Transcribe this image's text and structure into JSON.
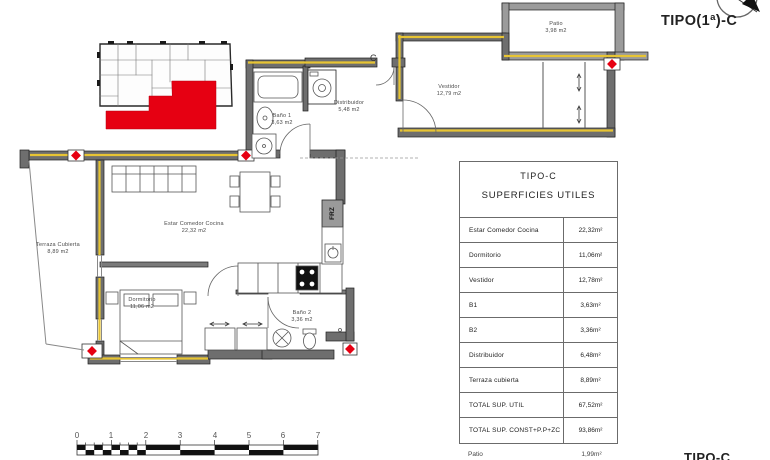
{
  "header": {
    "title": "TIPO(1ª)-C"
  },
  "footer": {
    "label": "TIPO-C"
  },
  "plan": {
    "section_marker": "C",
    "fridge_label": "FRZ",
    "rooms": [
      {
        "name": "Patio",
        "area": "3,98 m2"
      },
      {
        "name": "Vestidor",
        "area": "12,79 m2"
      },
      {
        "name": "Distribuidor",
        "area": "5,48 m2"
      },
      {
        "name": "Baño 1",
        "area": "3,63 m2"
      },
      {
        "name": "Estar Comedor Cocina",
        "area": "22,32 m2"
      },
      {
        "name": "Terraza Cubierta",
        "area": "8,89 m2"
      },
      {
        "name": "Dormitorio",
        "area": "11,06 m2"
      },
      {
        "name": "Baño 2",
        "area": "3,36 m2"
      }
    ]
  },
  "table": {
    "title_line1": "TIPO-C",
    "title_line2": "SUPERFICIES UTILES",
    "rows": [
      {
        "label": "Estar Comedor Cocina",
        "value": "22,32m²"
      },
      {
        "label": "Dormitorio",
        "value": "11,06m²"
      },
      {
        "label": "Vestidor",
        "value": "12,78m²"
      },
      {
        "label": "B1",
        "value": "3,63m²"
      },
      {
        "label": "B2",
        "value": "3,36m²"
      },
      {
        "label": "Distribuidor",
        "value": "6,48m²"
      },
      {
        "label": "Terraza cubierta",
        "value": "8,89m²"
      },
      {
        "label": "TOTAL SUP. UTIL",
        "value": "67,52m²"
      },
      {
        "label": "TOTAL SUP. CONST+P.P+ZC",
        "value": "93,86m²"
      }
    ],
    "extra_row": {
      "label": "Patio",
      "value": "1,99m²"
    }
  },
  "scalebar": {
    "labels": [
      "0",
      "1",
      "2",
      "3",
      "4",
      "5",
      "6",
      "7"
    ]
  },
  "colors": {
    "highlight_red": "#e60012",
    "insulation_yellow": "#e7c433",
    "wall_gray": "#6e6e6e"
  }
}
